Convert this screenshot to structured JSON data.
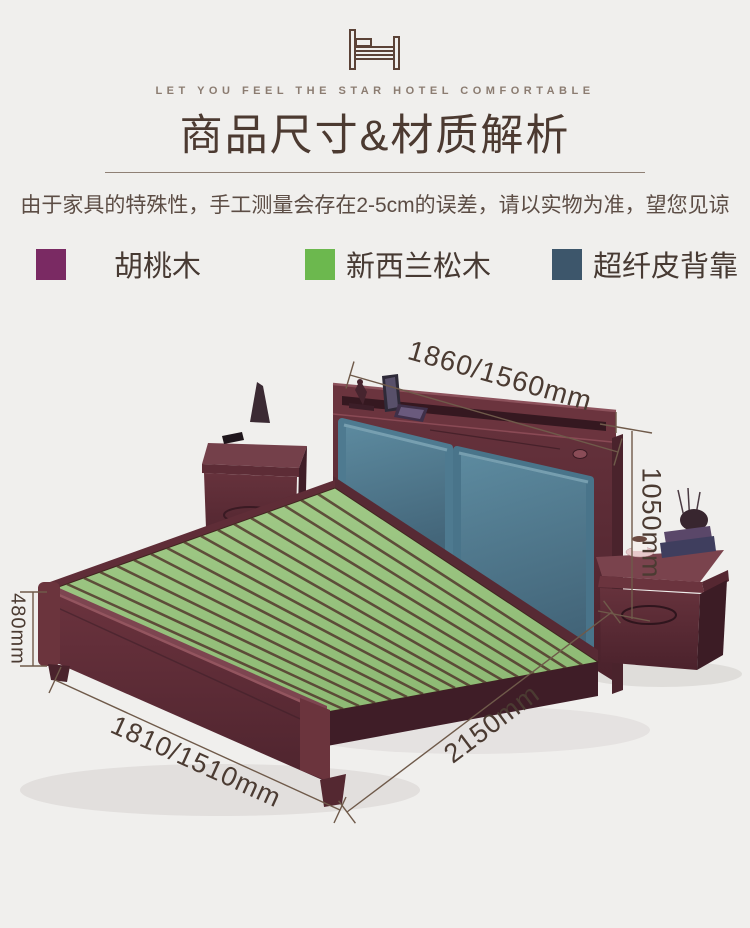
{
  "header": {
    "tagline": "LET YOU FEEL THE STAR HOTEL COMFORTABLE",
    "title": "商品尺寸&材质解析",
    "subtitle": "由于家具的特殊性，手工测量会存在2-5cm的误差，请以实物为准，望您见谅"
  },
  "legend": {
    "items": [
      {
        "id": "walnut",
        "label": "胡桃木",
        "color": "#7a2a63"
      },
      {
        "id": "nz-pine",
        "label": "新西兰松木",
        "color": "#6cb84e"
      },
      {
        "id": "microfiber-backrest",
        "label": "超纤皮背靠",
        "color": "#3d566b"
      }
    ]
  },
  "diagram": {
    "dimensions": {
      "headboard_width": "1860/1560mm",
      "headboard_height": "1050mm",
      "footboard_height": "480mm",
      "bed_width": "1810/1510mm",
      "bed_length": "2150mm"
    },
    "colors": {
      "walnut_wood": "#5c2c36",
      "pine_slats": "#98c27e",
      "leather_cushion": "#4e7a90",
      "dimension_line": "#6f5a4a",
      "background": "#f0efed"
    }
  }
}
